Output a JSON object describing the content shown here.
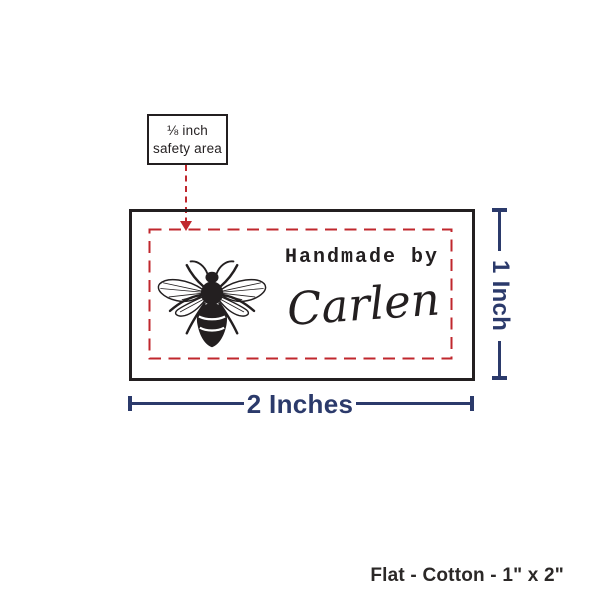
{
  "callout": {
    "line1": "⅛ inch",
    "line2": "safety area"
  },
  "label_preview": {
    "brand_line": "Handmade by",
    "name_line": "Carlen",
    "icon": "bee-illustration"
  },
  "dimensions": {
    "width_label": "2 Inches",
    "height_label": "1 Inch"
  },
  "footer": {
    "spec": "Flat - Cotton - 1\" x 2\""
  },
  "colors": {
    "dimension_navy": "#2B3A6B",
    "safety_red": "#C0272D",
    "ink_black": "#231F20"
  }
}
